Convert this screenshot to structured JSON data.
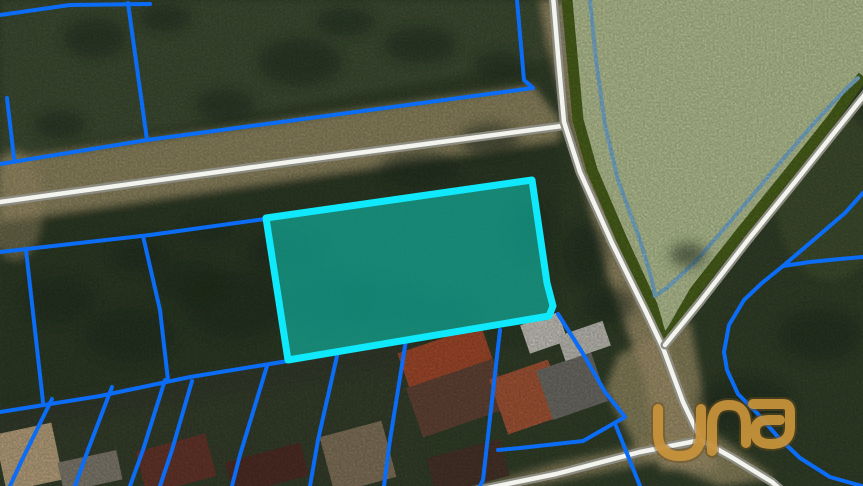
{
  "map": {
    "width": 863,
    "height": 486,
    "watermark_text": "una",
    "colors": {
      "veg_dark": "#36452c",
      "veg_mid": "#46553a",
      "veg_tree": "#222f1c",
      "dirt": "#b2a175",
      "road_white": "#f4f4ef",
      "road_casing": "#8c8c83",
      "field_green": "#c5d3a0",
      "field_yellow": "#dde2ab",
      "edge_olive": "#50691d",
      "edge_water": "#85bddd",
      "parcel_blue": "#0b6cf6",
      "highlight_cyan": "#10e9fb",
      "highlight_fill": "#0fbfae",
      "logo_gold": "#c6923a",
      "logo_dark": "#6b4d1b"
    },
    "patches": [
      {
        "shape": "polygon",
        "soft": true,
        "fill": "#46553a",
        "opacity": 0.85,
        "points": [
          [
            0,
            0
          ],
          [
            555,
            0
          ],
          [
            545,
            60
          ],
          [
            0,
            158
          ]
        ]
      },
      {
        "shape": "polygon",
        "soft": true,
        "fill": "#b2a175",
        "opacity": 0.8,
        "points": [
          [
            0,
            160
          ],
          [
            533,
            85
          ],
          [
            560,
            120
          ],
          [
            560,
            140
          ],
          [
            0,
            222
          ]
        ]
      },
      {
        "shape": "polygon",
        "soft": true,
        "fill": "#2c3a24",
        "opacity": 0.6,
        "points": [
          [
            0,
            222
          ],
          [
            560,
            140
          ],
          [
            560,
            340
          ],
          [
            0,
            432
          ]
        ]
      },
      {
        "shape": "polygon",
        "soft": true,
        "fill": "#b2a175",
        "opacity": 0.85,
        "points": [
          [
            540,
            0
          ],
          [
            578,
            0
          ],
          [
            592,
            120
          ],
          [
            625,
            255
          ],
          [
            668,
            350
          ],
          [
            703,
            440
          ],
          [
            720,
            470
          ],
          [
            660,
            470
          ],
          [
            645,
            380
          ],
          [
            605,
            270
          ],
          [
            575,
            150
          ],
          [
            548,
            45
          ]
        ]
      },
      {
        "shape": "polygon",
        "soft": false,
        "fill": "#c5d3a0",
        "opacity": 1,
        "points": [
          [
            567,
            0
          ],
          [
            863,
            0
          ],
          [
            863,
            76
          ],
          [
            833,
            118
          ],
          [
            790,
            172
          ],
          [
            743,
            230
          ],
          [
            695,
            293
          ],
          [
            661,
            336
          ],
          [
            652,
            305
          ],
          [
            622,
            240
          ],
          [
            592,
            170
          ],
          [
            578,
            120
          ],
          [
            572,
            55
          ]
        ]
      },
      {
        "shape": "ellipse",
        "soft": true,
        "fill": "#dde2ab",
        "opacity": 0.85,
        "cx": 690,
        "cy": 22,
        "rx": 115,
        "ry": 42
      },
      {
        "shape": "ellipse",
        "soft": true,
        "fill": "#dde2ab",
        "opacity": 0.6,
        "cx": 820,
        "cy": 28,
        "rx": 65,
        "ry": 38
      },
      {
        "shape": "ellipse",
        "soft": true,
        "fill": "#4d5c35",
        "opacity": 0.65,
        "cx": 830,
        "cy": 195,
        "rx": 55,
        "ry": 85
      },
      {
        "shape": "polygon",
        "soft": true,
        "fill": "#b2a175",
        "opacity": 0.75,
        "points": [
          [
            618,
            355
          ],
          [
            690,
            320
          ],
          [
            710,
            430
          ],
          [
            775,
            478
          ],
          [
            720,
            486
          ],
          [
            640,
            455
          ],
          [
            605,
            390
          ]
        ]
      },
      {
        "shape": "polygon",
        "soft": true,
        "fill": "#b2a175",
        "opacity": 0.7,
        "points": [
          [
            455,
            492
          ],
          [
            560,
            462
          ],
          [
            703,
            432
          ],
          [
            708,
            452
          ],
          [
            565,
            480
          ],
          [
            470,
            498
          ]
        ]
      },
      {
        "shape": "polygon",
        "soft": true,
        "fill": "#3d4434",
        "opacity": 0.5,
        "points": [
          [
            0,
            408
          ],
          [
            290,
            358
          ],
          [
            420,
            340
          ],
          [
            420,
            486
          ],
          [
            0,
            486
          ]
        ]
      },
      {
        "shape": "ellipse",
        "soft": true,
        "fill": "#b2a175",
        "opacity": 0.5,
        "cx": 15,
        "cy": 205,
        "rx": 28,
        "ry": 55
      },
      {
        "shape": "ellipse",
        "soft": true,
        "fill": "#9a9a90",
        "opacity": 0.5,
        "cx": 575,
        "cy": 30,
        "rx": 18,
        "ry": 40
      }
    ],
    "tree_blobs": [
      [
        95,
        38,
        32,
        20
      ],
      [
        165,
        18,
        26,
        14
      ],
      [
        300,
        62,
        42,
        24
      ],
      [
        225,
        105,
        30,
        16
      ],
      [
        420,
        45,
        36,
        18
      ],
      [
        345,
        22,
        30,
        14
      ],
      [
        500,
        65,
        26,
        14
      ],
      [
        60,
        125,
        26,
        14
      ],
      [
        140,
        255,
        30,
        18
      ],
      [
        60,
        300,
        36,
        24
      ],
      [
        130,
        335,
        46,
        28
      ],
      [
        235,
        305,
        52,
        34
      ],
      [
        330,
        300,
        46,
        30
      ],
      [
        285,
        252,
        40,
        22
      ],
      [
        190,
        282,
        36,
        22
      ],
      [
        385,
        305,
        42,
        26
      ],
      [
        445,
        315,
        30,
        18
      ],
      [
        585,
        255,
        22,
        32
      ],
      [
        608,
        305,
        26,
        18
      ],
      [
        745,
        405,
        48,
        28
      ],
      [
        820,
        335,
        42,
        26
      ],
      [
        688,
        255,
        18,
        12
      ],
      [
        210,
        230,
        25,
        12
      ],
      [
        490,
        140,
        30,
        16
      ],
      [
        420,
        170,
        40,
        18
      ],
      [
        530,
        230,
        20,
        30
      ]
    ],
    "houses": [
      {
        "x": 402,
        "y": 338,
        "w": 88,
        "h": 42,
        "rot": -19,
        "fill": "#b0502f"
      },
      {
        "x": 412,
        "y": 372,
        "w": 92,
        "h": 52,
        "rot": -19,
        "fill": "#6b4a3a"
      },
      {
        "x": 497,
        "y": 368,
        "w": 62,
        "h": 58,
        "rot": -19,
        "fill": "#b25c3b"
      },
      {
        "x": 543,
        "y": 360,
        "w": 58,
        "h": 52,
        "rot": -19,
        "fill": "#77756e"
      },
      {
        "x": 524,
        "y": 318,
        "w": 40,
        "h": 30,
        "rot": -19,
        "fill": "#d8d5cc"
      },
      {
        "x": 560,
        "y": 328,
        "w": 48,
        "h": 26,
        "rot": -19,
        "fill": "#cfcdc4"
      },
      {
        "x": 0,
        "y": 428,
        "w": 58,
        "h": 58,
        "rot": -12,
        "fill": "#c9b088"
      },
      {
        "x": 140,
        "y": 442,
        "w": 72,
        "h": 44,
        "rot": -15,
        "fill": "#6e3a2e"
      },
      {
        "x": 228,
        "y": 452,
        "w": 78,
        "h": 34,
        "rot": -15,
        "fill": "#553128"
      },
      {
        "x": 326,
        "y": 428,
        "w": 64,
        "h": 58,
        "rot": -15,
        "fill": "#8d7d62"
      },
      {
        "x": 430,
        "y": 448,
        "w": 76,
        "h": 38,
        "rot": -15,
        "fill": "#4e382c"
      },
      {
        "x": 60,
        "y": 456,
        "w": 60,
        "h": 30,
        "rot": -12,
        "fill": "#8b8577"
      }
    ],
    "field_edge": {
      "olive": [
        [
          567,
          0
        ],
        [
          572,
          55
        ],
        [
          578,
          120
        ],
        [
          592,
          170
        ],
        [
          622,
          240
        ],
        [
          652,
          305
        ],
        [
          661,
          336
        ],
        [
          668,
          338
        ],
        [
          695,
          291
        ],
        [
          743,
          230
        ],
        [
          790,
          172
        ],
        [
          833,
          118
        ],
        [
          860,
          80
        ],
        [
          863,
          76
        ]
      ],
      "water": [
        [
          590,
          0
        ],
        [
          596,
          60
        ],
        [
          605,
          125
        ],
        [
          618,
          180
        ],
        [
          640,
          240
        ],
        [
          652,
          280
        ],
        [
          655,
          296
        ],
        [
          668,
          287
        ],
        [
          695,
          262
        ],
        [
          730,
          222
        ],
        [
          772,
          172
        ],
        [
          815,
          122
        ],
        [
          845,
          90
        ],
        [
          858,
          78
        ]
      ]
    },
    "roads": [
      {
        "name": "road-west",
        "points": [
          [
            0,
            202
          ],
          [
            290,
            162
          ],
          [
            562,
            126
          ]
        ]
      },
      {
        "name": "road-north-south",
        "points": [
          [
            553,
            -4
          ],
          [
            558,
            55
          ],
          [
            564,
            122
          ],
          [
            580,
            172
          ],
          [
            612,
            243
          ],
          [
            646,
            312
          ],
          [
            663,
            348
          ],
          [
            683,
            402
          ],
          [
            701,
            440
          ]
        ]
      },
      {
        "name": "road-field-east",
        "points": [
          [
            866,
            93
          ],
          [
            838,
            128
          ],
          [
            795,
            182
          ],
          [
            748,
            240
          ],
          [
            700,
            302
          ],
          [
            665,
            345
          ]
        ]
      },
      {
        "name": "road-bottom-left",
        "points": [
          [
            701,
            440
          ],
          [
            640,
            452
          ],
          [
            556,
            474
          ],
          [
            468,
            492
          ]
        ]
      },
      {
        "name": "road-bottom-right",
        "points": [
          [
            701,
            440
          ],
          [
            733,
            458
          ],
          [
            772,
            482
          ],
          [
            788,
            496
          ]
        ]
      }
    ],
    "parcel_lines": [
      {
        "points": [
          [
            0,
            15
          ],
          [
            70,
            5
          ],
          [
            150,
            4
          ]
        ]
      },
      {
        "points": [
          [
            128,
            3
          ],
          [
            147,
            140
          ]
        ]
      },
      {
        "points": [
          [
            7,
            98
          ],
          [
            14,
            158
          ]
        ]
      },
      {
        "points": [
          [
            0,
            164
          ],
          [
            147,
            140
          ],
          [
            533,
            88
          ]
        ]
      },
      {
        "points": [
          [
            517,
            0
          ],
          [
            524,
            80
          ],
          [
            533,
            88
          ]
        ]
      },
      {
        "points": [
          [
            0,
            252
          ],
          [
            150,
            235
          ],
          [
            265,
            219
          ]
        ]
      },
      {
        "points": [
          [
            26,
            250
          ],
          [
            43,
            402
          ]
        ]
      },
      {
        "points": [
          [
            143,
            236
          ],
          [
            160,
            310
          ],
          [
            168,
            380
          ]
        ]
      },
      {
        "points": [
          [
            0,
            412
          ],
          [
            100,
            396
          ],
          [
            190,
            377
          ],
          [
            288,
            361
          ]
        ]
      },
      {
        "points": [
          [
            52,
            399
          ],
          [
            22,
            460
          ],
          [
            10,
            486
          ]
        ]
      },
      {
        "points": [
          [
            112,
            387
          ],
          [
            88,
            450
          ],
          [
            75,
            486
          ]
        ]
      },
      {
        "points": [
          [
            165,
            380
          ],
          [
            143,
            450
          ],
          [
            130,
            486
          ]
        ]
      },
      {
        "points": [
          [
            192,
            381
          ],
          [
            172,
            450
          ],
          [
            160,
            486
          ]
        ]
      },
      {
        "points": [
          [
            267,
            366
          ],
          [
            240,
            455
          ],
          [
            232,
            486
          ]
        ]
      },
      {
        "points": [
          [
            337,
            356
          ],
          [
            318,
            440
          ],
          [
            310,
            486
          ]
        ]
      },
      {
        "points": [
          [
            406,
            340
          ],
          [
            390,
            440
          ],
          [
            384,
            486
          ]
        ]
      },
      {
        "points": [
          [
            500,
            330
          ],
          [
            483,
            480
          ],
          [
            480,
            486
          ]
        ]
      },
      {
        "points": [
          [
            558,
            314
          ],
          [
            582,
            352
          ],
          [
            605,
            392
          ],
          [
            625,
            417
          ]
        ]
      },
      {
        "points": [
          [
            625,
            417
          ],
          [
            583,
            441
          ],
          [
            520,
            448
          ],
          [
            498,
            450
          ]
        ]
      },
      {
        "points": [
          [
            616,
            426
          ],
          [
            628,
            456
          ],
          [
            640,
            486
          ]
        ]
      },
      {
        "points": [
          [
            863,
            193
          ],
          [
            845,
            213
          ],
          [
            810,
            243
          ],
          [
            783,
            266
          ],
          [
            762,
            283
          ],
          [
            744,
            300
          ],
          [
            729,
            325
          ],
          [
            724,
            352
          ],
          [
            727,
            370
          ],
          [
            738,
            394
          ],
          [
            757,
            413
          ],
          [
            778,
            437
          ],
          [
            800,
            458
          ],
          [
            830,
            477
          ],
          [
            862,
            486
          ]
        ]
      },
      {
        "points": [
          [
            783,
            266
          ],
          [
            810,
            262
          ],
          [
            840,
            259
          ],
          [
            863,
            257
          ]
        ]
      }
    ],
    "highlight_parcel": {
      "points": [
        [
          266,
          218
        ],
        [
          532,
          180
        ],
        [
          547,
          283
        ],
        [
          553,
          306
        ],
        [
          549,
          316
        ],
        [
          288,
          360
        ]
      ],
      "stroke_width": 7,
      "fill_opacity": 0.6
    },
    "logo": {
      "text": "una",
      "paths": [
        "M658 409 V433 Q658 456 680 456 Q701 456 701 433 V409",
        "M712 451 V425 Q712 405 729 405 Q746 405 746 425 V443",
        "M753 404 L783 404 Q790 404 790 412 L790 427 Q790 444 771 444 Q755 444 755 431 Q755 420 769 420 L780 420"
      ],
      "opacity": 0.95
    }
  }
}
